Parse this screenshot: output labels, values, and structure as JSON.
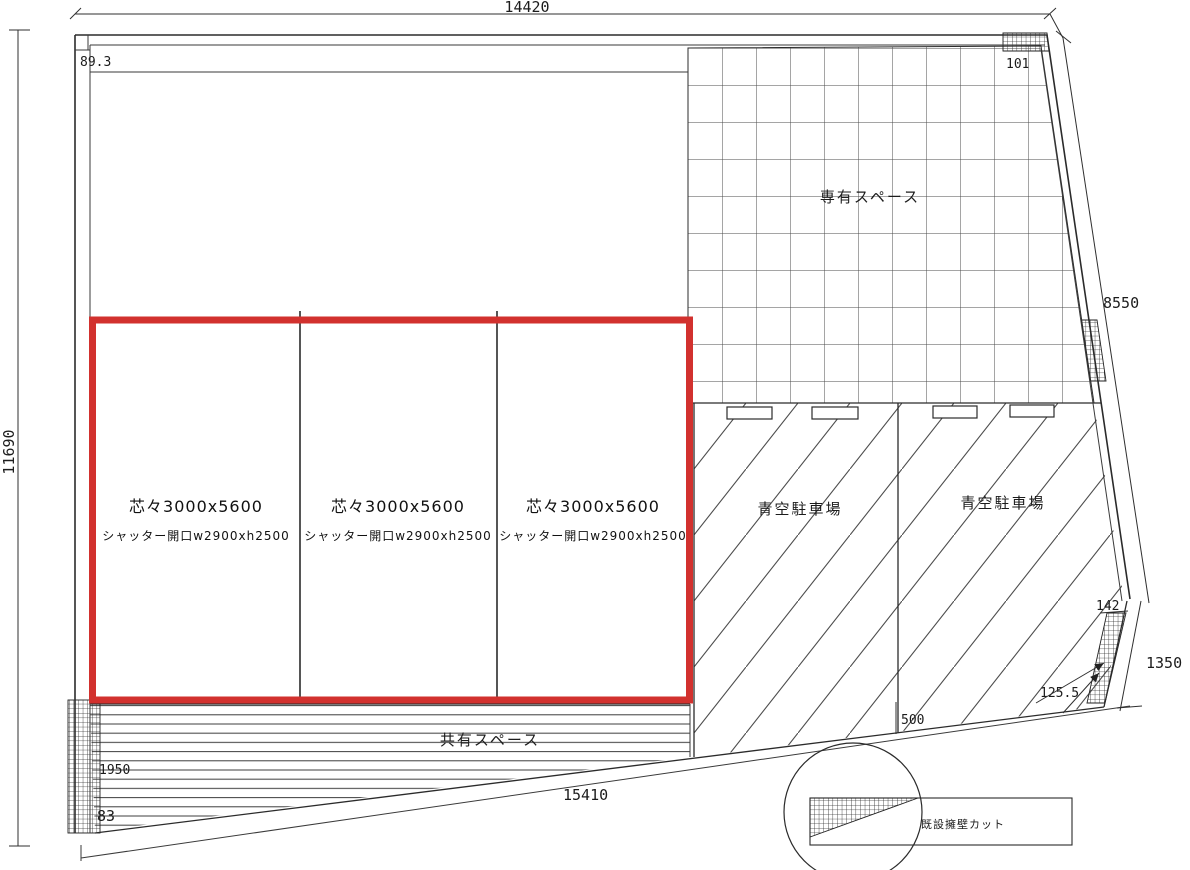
{
  "drawing": {
    "type": "site-plan",
    "highlight_color": "#d2312e",
    "line_color": "#2b2b2b",
    "dims": {
      "top": "14420",
      "left": "11690",
      "right_slant": "8550",
      "right_lower": "1350",
      "bottom": "15410",
      "offset_top_left": "89.3",
      "offset_top_right": "101",
      "corner_right": "142",
      "wall_offset": "125.5",
      "parking_offset": "500",
      "common_depth": "1950",
      "offset_bottom_left": "83"
    },
    "labels": {
      "exclusive_space": "専有スペース",
      "open_parking_1": "青空駐車場",
      "open_parking_2": "青空駐車場",
      "common_space": "共有スペース",
      "retaining_wall_cut": "既設擁壁カット"
    },
    "garage_units": [
      {
        "pitch": "芯々3000x5600",
        "shutter_opening": "シャッター開口w2900xh2500"
      },
      {
        "pitch": "芯々3000x5600",
        "shutter_opening": "シャッター開口w2900xh2500"
      },
      {
        "pitch": "芯々3000x5600",
        "shutter_opening": "シャッター開口w2900xh2500"
      }
    ]
  }
}
